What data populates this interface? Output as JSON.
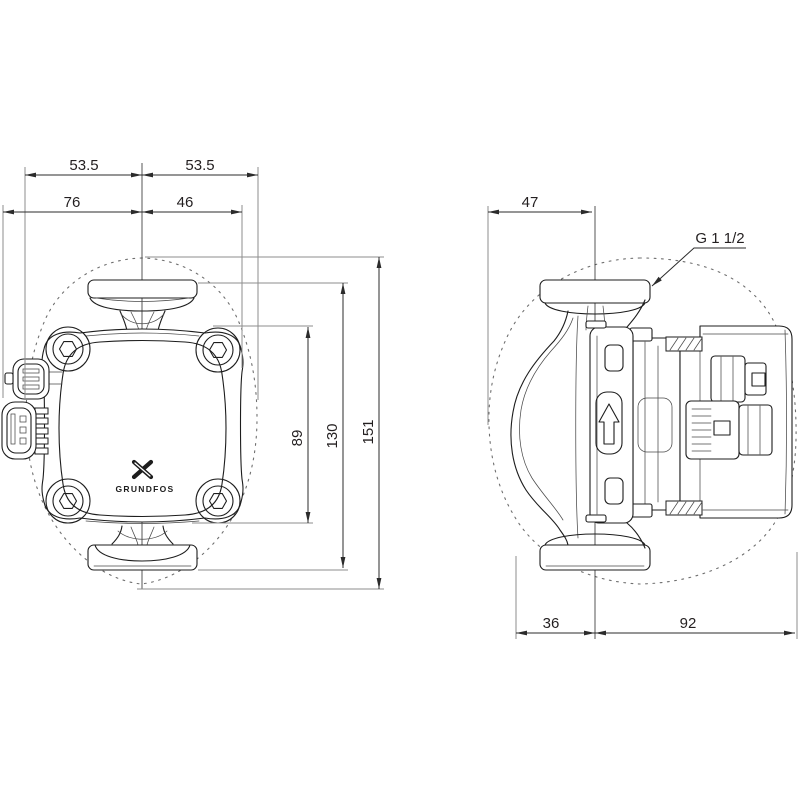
{
  "front_view": {
    "brand_logo_text": "GRUNDFOS",
    "dims": {
      "flange_left": "53.5",
      "flange_right": "53.5",
      "left_of_center": "76",
      "right_of_center": "46",
      "housing_height": "89",
      "flange_to_flange": "130",
      "overall_height": "151"
    }
  },
  "side_view": {
    "thread_label": "G 1 1/2",
    "dims": {
      "front_to_center": "47",
      "center_to_front": "36",
      "center_to_rear": "92"
    }
  },
  "colors": {
    "line": "#1d1d1d",
    "dimension": "#2b2b2b",
    "reference": "#8e8e8e",
    "envelope": "#6f6f6f",
    "background": "#ffffff"
  }
}
